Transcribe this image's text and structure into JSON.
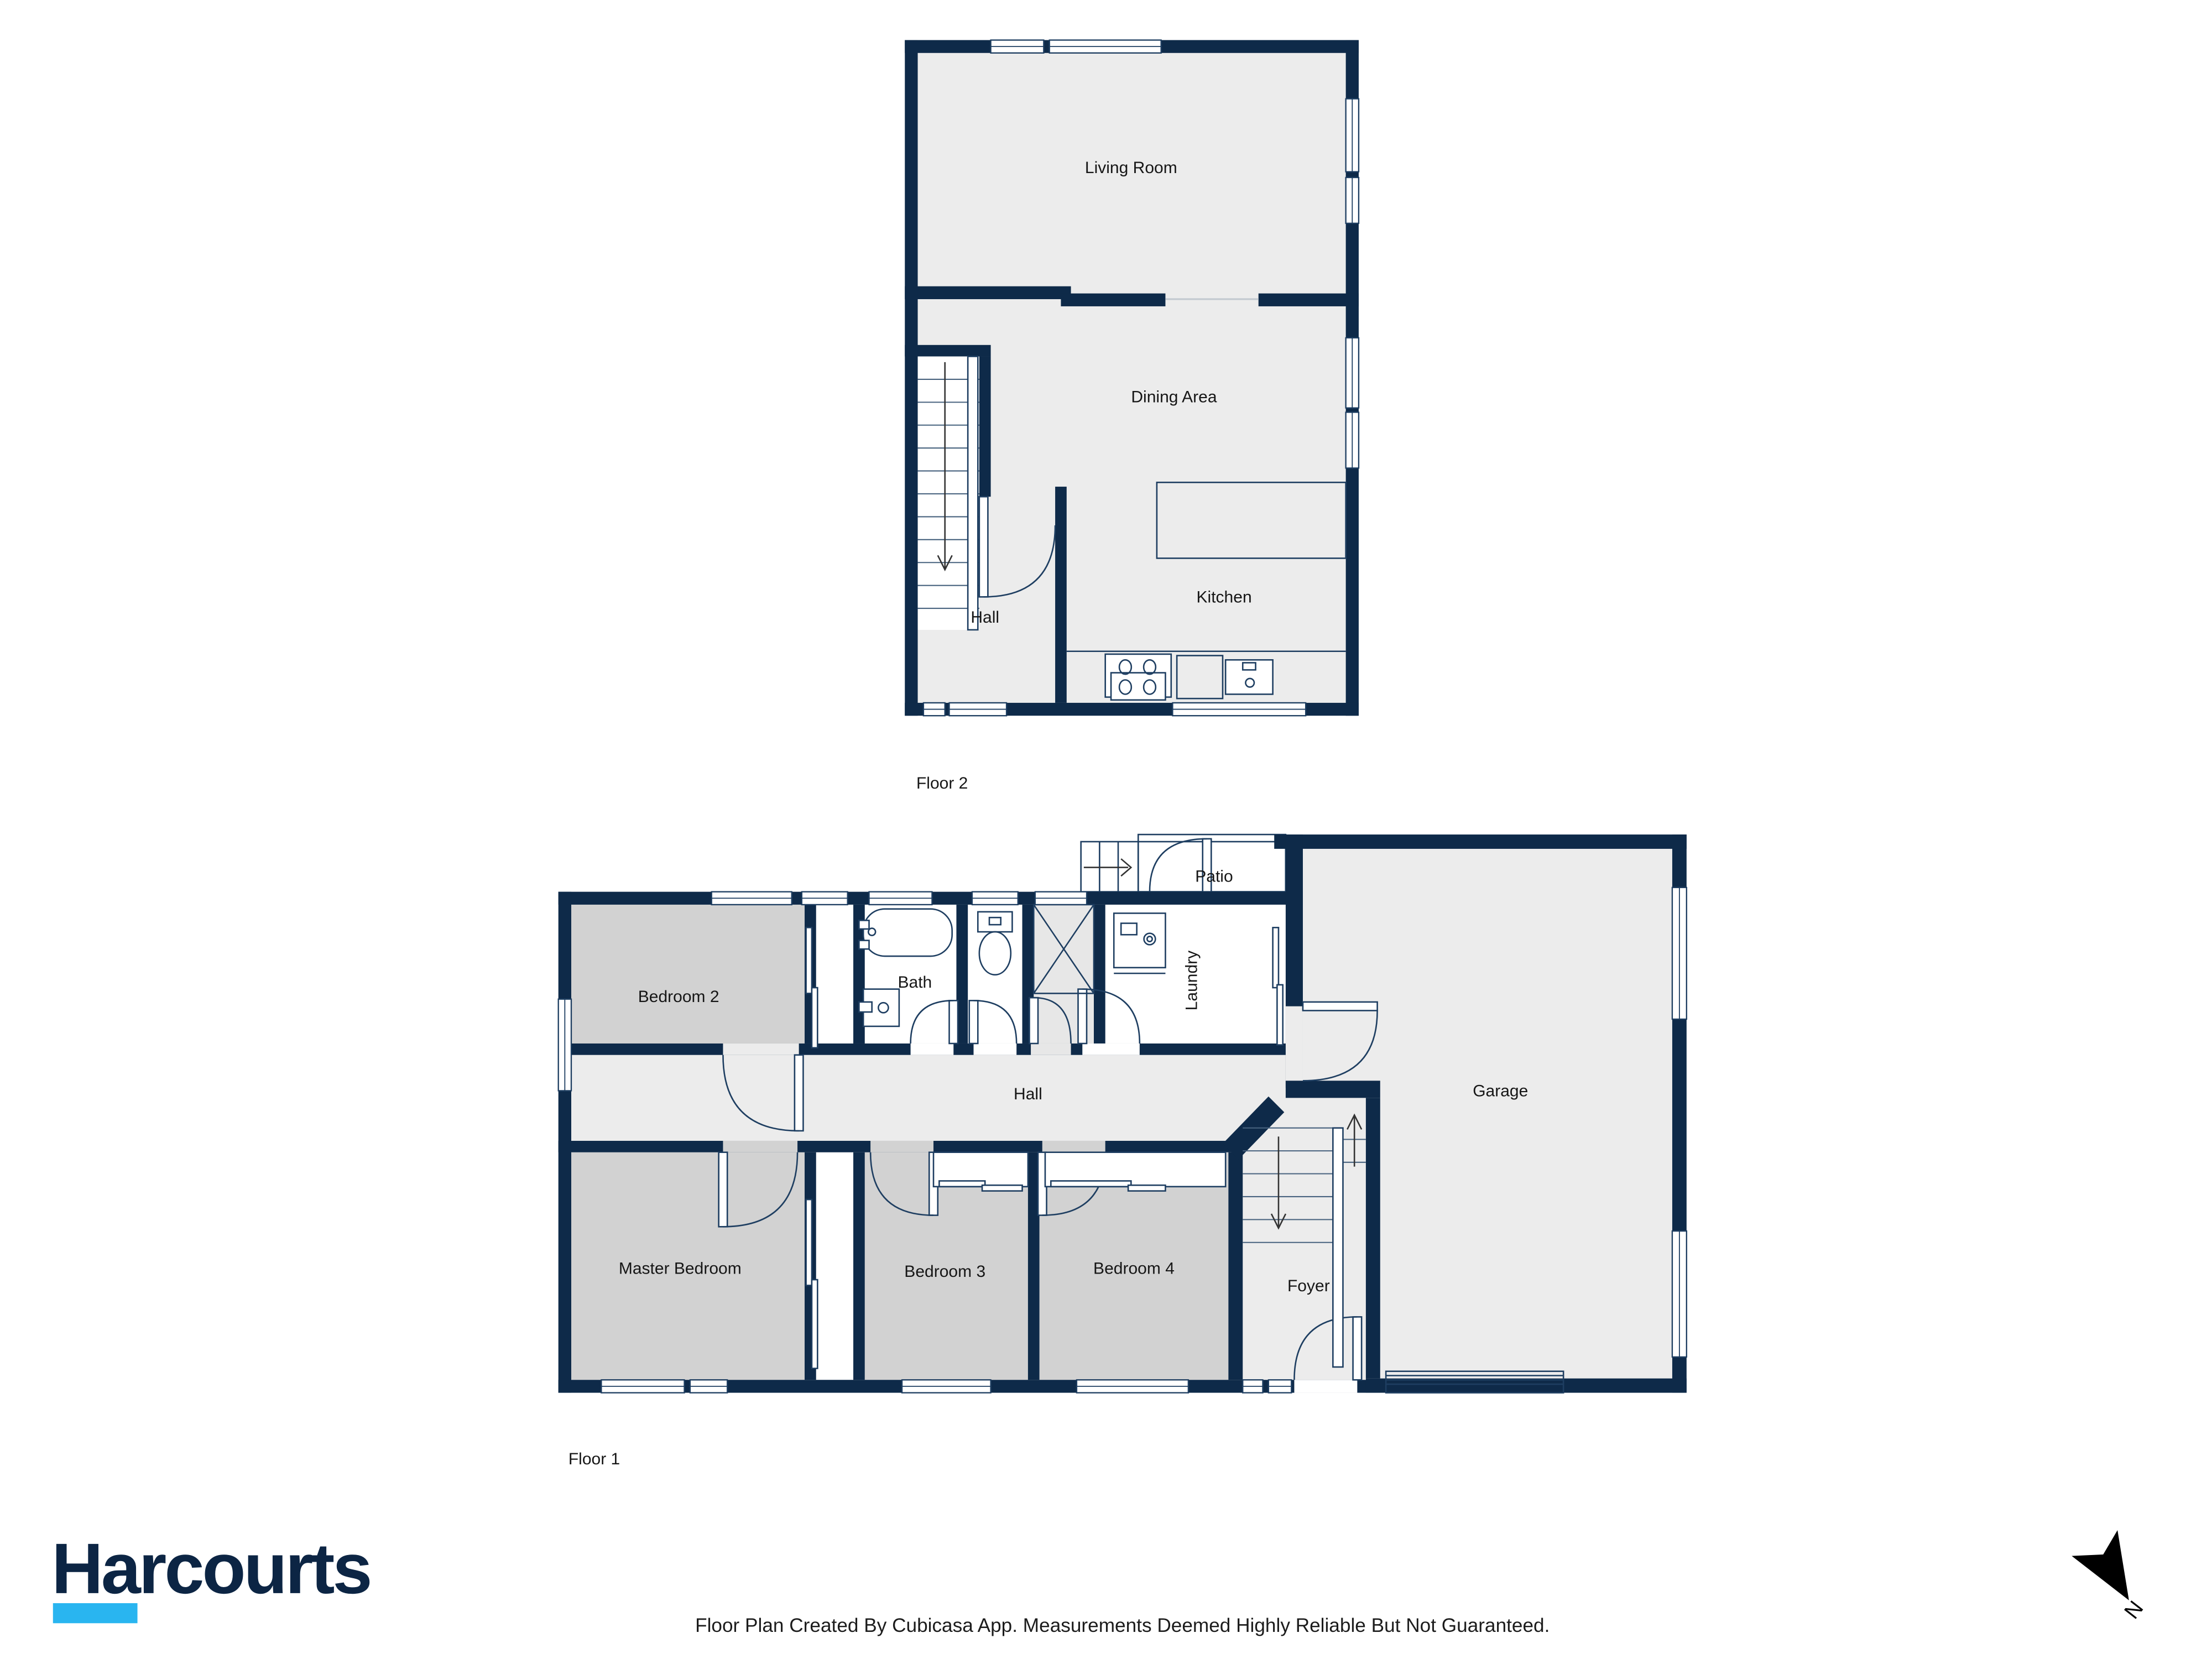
{
  "floor2": {
    "label": "Floor 2",
    "living": "Living Room",
    "dining": "Dining Area",
    "hall": "Hall",
    "kitchen": "Kitchen"
  },
  "floor1": {
    "label": "Floor 1",
    "bedroom2": "Bedroom 2",
    "bath": "Bath",
    "laundry": "Laundry",
    "patio": "Patio",
    "garage": "Garage",
    "hall": "Hall",
    "master": "Master Bedroom",
    "bedroom3": "Bedroom 3",
    "bedroom4": "Bedroom 4",
    "foyer": "Foyer"
  },
  "branding": {
    "name": "Harcourts"
  },
  "footer": {
    "text": "Floor Plan Created By Cubicasa App. Measurements Deemed Highly Reliable But Not Guaranteed."
  },
  "compass": {
    "north": "N"
  },
  "colors": {
    "wall": "#0e2a49",
    "room_light": "#ececec",
    "bedroom_gray": "#d2d2d2",
    "shower_gray": "#e7e7e7",
    "patio_tan": "#e5d2a9",
    "logo_navy": "#0c2544",
    "logo_cyan": "#29b5f0"
  }
}
